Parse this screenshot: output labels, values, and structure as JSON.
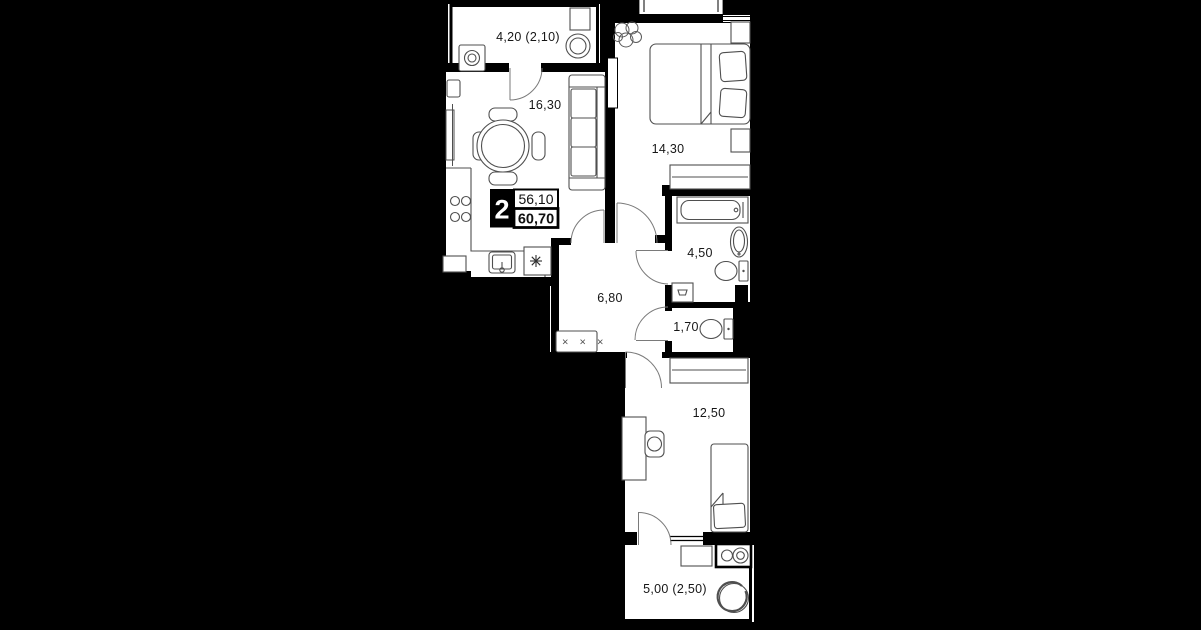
{
  "plan": {
    "unit_card": {
      "rooms_count": "2",
      "area_upper": "56,10",
      "area_lower": "60,70"
    },
    "room_labels": {
      "balcony_top": "4,20 (2,10)",
      "kitchen_living": "16,30",
      "bedroom": "14,30",
      "bathroom": "4,50",
      "hallway": "6,80",
      "wc": "1,70",
      "bedroom_second": "12,50",
      "balcony_bottom": "5,00 (2,50)"
    },
    "glyphs": {
      "closet_marks": "× × ×"
    },
    "colors": {
      "background": "#000000",
      "floor": "#ffffff",
      "wall": "#000000",
      "furniture_line": "#4f4f4f",
      "label_text": "#161616"
    }
  }
}
